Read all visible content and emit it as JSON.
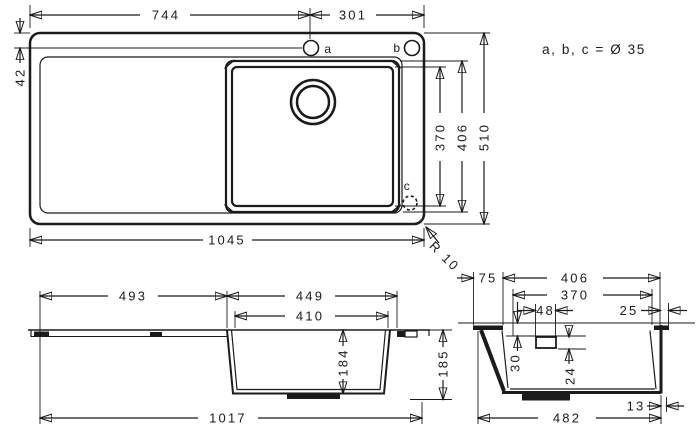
{
  "note": "a, b, c = Ø 35",
  "radius_label": "R 10",
  "top_view": {
    "dim_744": "744",
    "dim_301": "301",
    "dim_42": "42",
    "dim_370": "370",
    "dim_406": "406",
    "dim_510": "510",
    "dim_1045": "1045",
    "label_a": "a",
    "label_b": "b",
    "label_c": "c"
  },
  "side_view": {
    "dim_493": "493",
    "dim_449": "449",
    "dim_410": "410",
    "dim_184": "184",
    "dim_185": "185",
    "dim_1017": "1017"
  },
  "section_view": {
    "dim_75": "75",
    "dim_406": "406",
    "dim_370": "370",
    "dim_48": "48",
    "dim_25": "25",
    "dim_30": "30",
    "dim_24": "24",
    "dim_13": "13",
    "dim_482": "482"
  }
}
